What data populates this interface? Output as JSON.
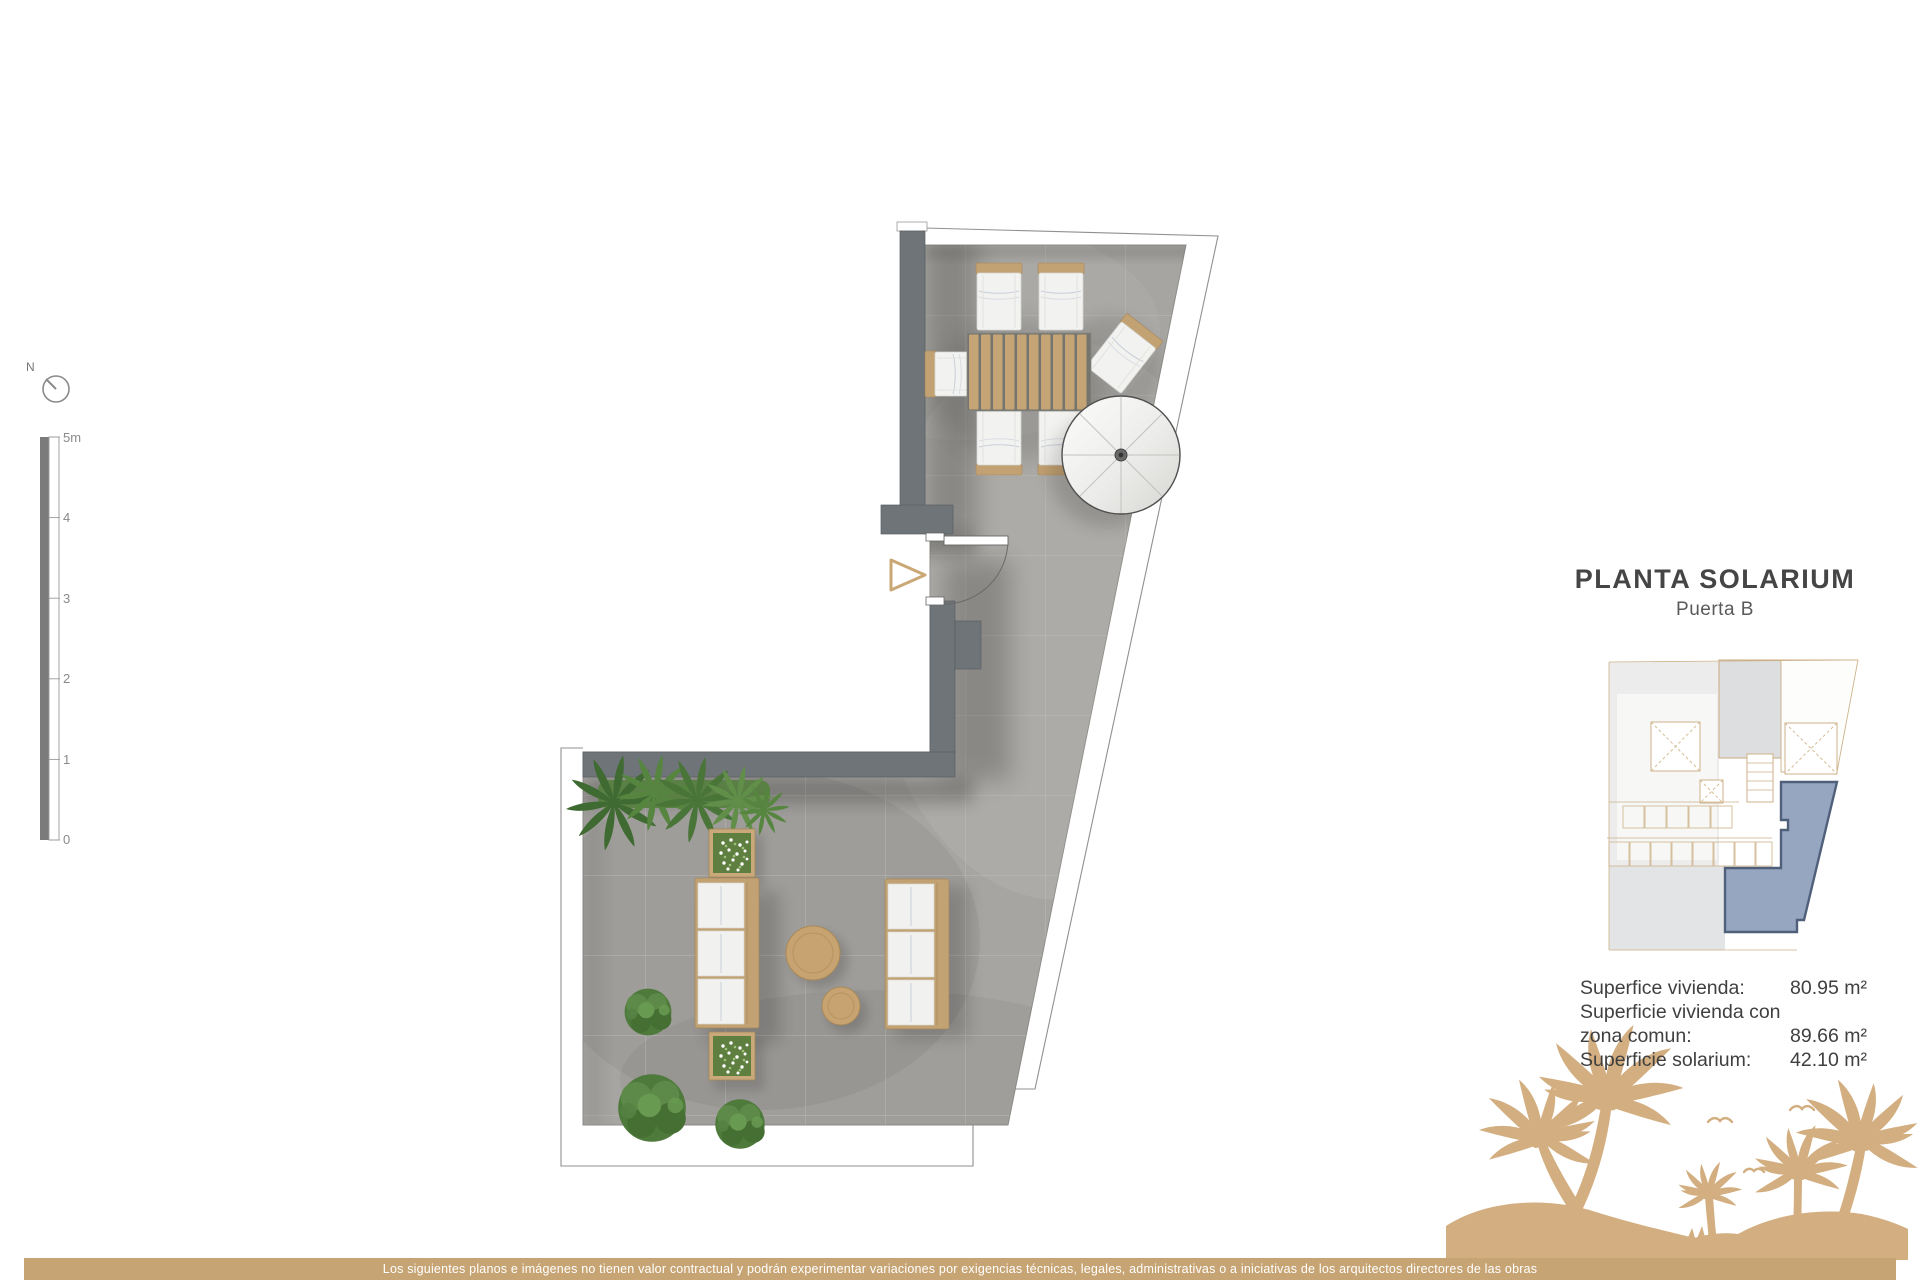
{
  "title": {
    "main": "PLANTA SOLARIUM",
    "subtitle": "Puerta B"
  },
  "areas": {
    "labels": [
      "Superfice vivienda:",
      "Superficie vivienda con",
      "zona comun:",
      "Superficie solarium:"
    ],
    "values": [
      "80.95 m²",
      "89.66 m²",
      "42.10 m²"
    ]
  },
  "scale_bar": {
    "unit": "m",
    "labels": [
      "5m",
      "4",
      "3",
      "2",
      "1",
      "0"
    ]
  },
  "north": {
    "label": "N"
  },
  "key_plan": {
    "highlighted_unit": "Puerta B solarium"
  },
  "disclaimer": "Los siguientes planos e imágenes no tienen valor contractual y podrán experimentar variaciones por exigencias técnicas, legales, administrativas o a iniciativas de los arquitectos directores de las obras",
  "plan_features": [
    "terrace-floor",
    "dining-table",
    "dining-chairs",
    "parasol",
    "sun-loungers",
    "side-tables",
    "planter-boxes",
    "plants",
    "door-swing",
    "entry-arrow"
  ],
  "colors": {
    "accent_gold": "#c9a876",
    "bottom_bar": "#c7a474",
    "palm_silhouette": "#d3ae80",
    "wall_gray": "#6e7477",
    "floor_gray": "#a7a5a1",
    "cushion_white": "#f1f1ef",
    "plant_green": "#55853f",
    "key_plan_highlight_fill": "#96a5c0",
    "key_plan_highlight_stroke": "#51607a",
    "title_text": "#454545"
  }
}
